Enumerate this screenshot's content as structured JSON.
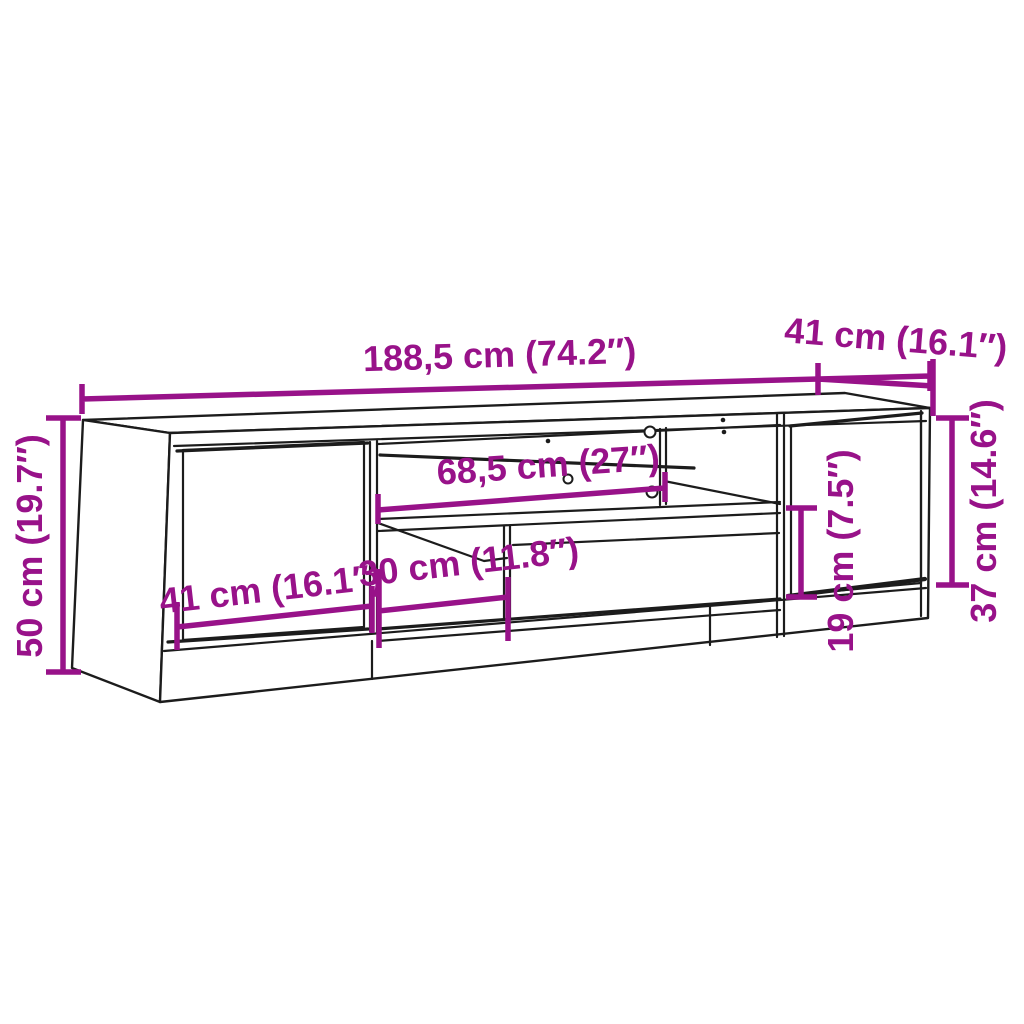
{
  "diagram": {
    "subject": "TV stand line drawing with dimensions",
    "dims": {
      "overall_width": "188,5 cm (74.2″)",
      "overall_depth": "41 cm (16.1″)",
      "overall_height": "50 cm (19.7″)",
      "right_door_height": "37 cm (14.6″)",
      "middle_compartment_width": "68,5 cm (27″)",
      "left_door_width": "41 cm (16.1″)",
      "lower_compartment_width": "30 cm (11.8″)",
      "lower_compartment_height": "19 cm (7.5″)"
    }
  },
  "colors": {
    "accent": "#981289",
    "line": "#1c1c1c",
    "background": "#ffffff"
  }
}
